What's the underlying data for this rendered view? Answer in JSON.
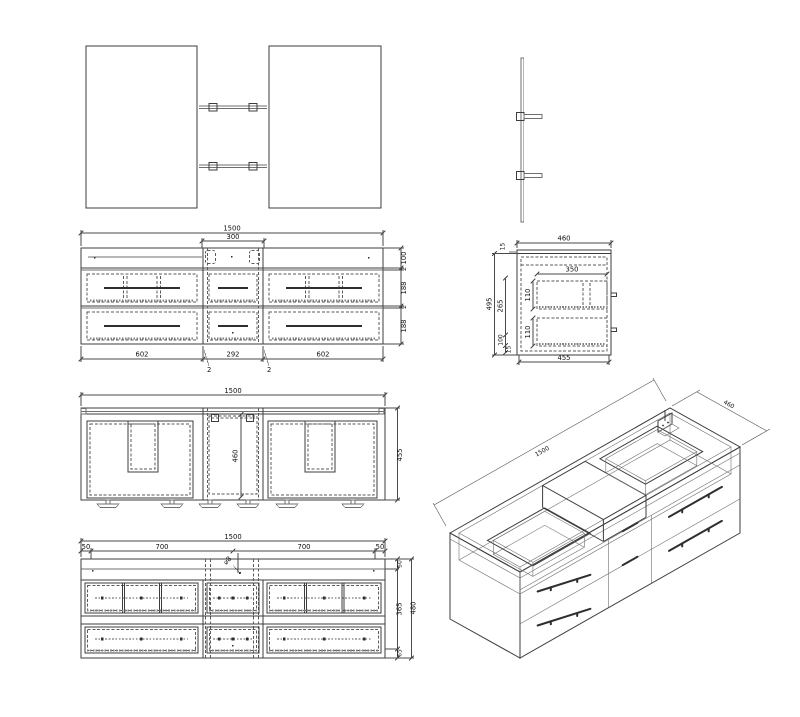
{
  "drawing": {
    "front_view": {
      "dims": {
        "total": "1500",
        "center_top": "300",
        "col_left": "602",
        "col_center": "292",
        "col_right": "602",
        "row_top": "100",
        "gap_top": "2",
        "row_mid": "188",
        "gap_mid": "2",
        "row_bot": "188",
        "sec_left": "2",
        "sec_right": "2"
      }
    },
    "side_view": {
      "dims": {
        "width_top": "460",
        "counter": "15",
        "inner_width": "350",
        "height_overall": "495",
        "seg_mid": "265",
        "drawer_up": "110",
        "drawer_low": "110",
        "seg_low": "100",
        "seg_bottom": "15",
        "width_bottom": "455"
      }
    },
    "plan_view": {
      "dims": {
        "width": "1500",
        "center_depth": "460",
        "depth": "455"
      }
    },
    "rear_view": {
      "dims": {
        "width": "1500",
        "m_left": "50",
        "span_left": "700",
        "span_right": "700",
        "m_right": "50",
        "h_top": "50",
        "h_mid": "365",
        "h_total": "480",
        "h_bot": "65",
        "hole": "⌀8"
      }
    },
    "isometric": {
      "dims": {
        "length": "1500",
        "depth": "460"
      }
    },
    "colors": {
      "line": "#3d3d3d",
      "hidden": "#5a5a5a",
      "background": "#ffffff"
    }
  }
}
